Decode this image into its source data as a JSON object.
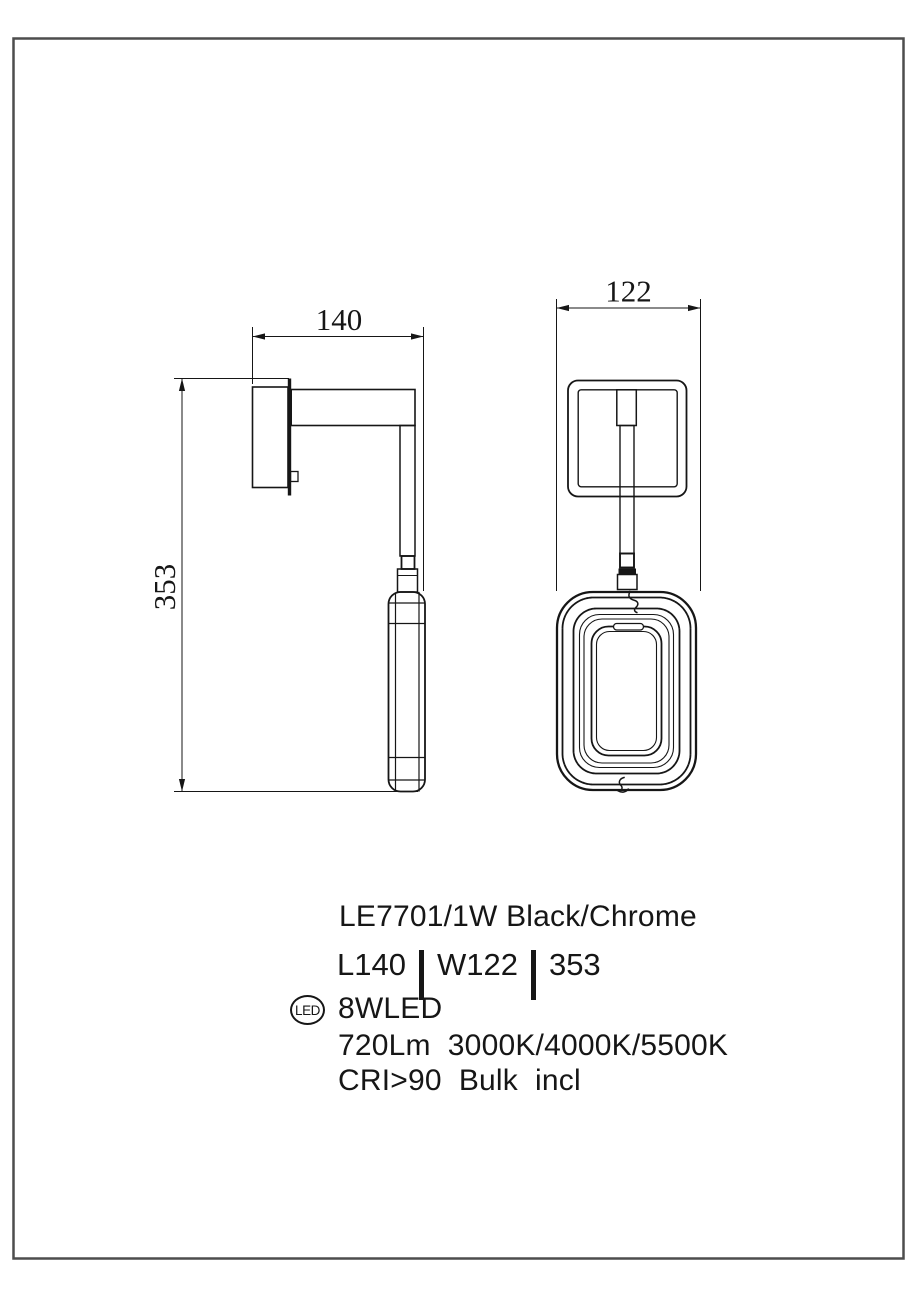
{
  "page": {
    "background": "#ffffff",
    "border_color": "#4d4d4d",
    "line_color": "#161616"
  },
  "dimensions": {
    "arm_length": "140",
    "shade_width": "122",
    "overall_height": "353"
  },
  "specs": {
    "model": "LE7701/1W Black/Chrome",
    "length": "L140",
    "width": "W122",
    "height": "353",
    "led_badge": "LED",
    "power": "8WLED",
    "output": "720Lm  3000K/4000K/5500K",
    "cri": "CRI>90  Bulk  incl"
  }
}
